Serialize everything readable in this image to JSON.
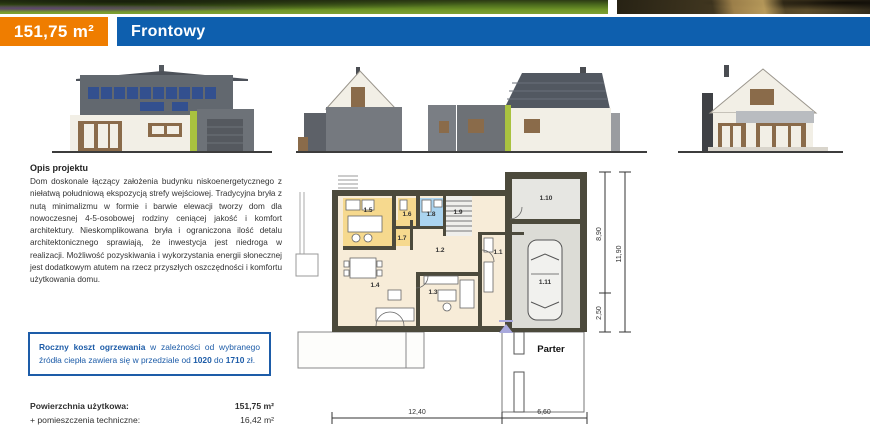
{
  "header": {
    "area": "151,75 m²",
    "project_name": "Frontowy"
  },
  "description": {
    "title": "Opis projektu",
    "body": "Dom doskonale łączący założenia budynku nisko­energetycznego z niełatwą południową ekspozycją strefy wejściowej. Tradycyjna bryła z nutą minimalizmu w formie i barwie elewacji tworzy dom dla nowoczesnej 4-5-osobowej rodziny ceniącej jakość i komfort architektury. Nieskomplikowana bryła i ograniczona ilość detalu architektonicznego sprawiają, że inwestycja jest niedroga w realizacji. Możliwość pozyskiwania i wykorzystania energii słonecznej jest dodatkowym atutem na rzecz przyszłych oszczędności i komfortu użytkowania domu."
  },
  "info_box": {
    "segments": [
      {
        "text": "Roczny koszt ogrzewania",
        "bold": true
      },
      {
        "text": " w zależności od wybranego źródła ciepła zawiera się w przedziale od ",
        "bold": false
      },
      {
        "text": "1020",
        "bold": true
      },
      {
        "text": " do ",
        "bold": false
      },
      {
        "text": "1710",
        "bold": true
      },
      {
        "text": " zł.",
        "bold": false
      }
    ]
  },
  "areas": {
    "rows": [
      {
        "label": "Powierzchnia użytkowa:",
        "value": "151,75 m²"
      },
      {
        "label": "+ pomieszczenia techniczne:",
        "value": "16,42 m²"
      }
    ]
  },
  "plan": {
    "floor_label": "Parter",
    "rooms": [
      {
        "id": "1.1"
      },
      {
        "id": "1.2"
      },
      {
        "id": "1.3"
      },
      {
        "id": "1.4"
      },
      {
        "id": "1.5"
      },
      {
        "id": "1.6"
      },
      {
        "id": "1.7"
      },
      {
        "id": "1.8"
      },
      {
        "id": "1.9"
      },
      {
        "id": "1.10"
      },
      {
        "id": "1.11"
      }
    ],
    "dimensions": {
      "bottom_main": "12,40",
      "bottom_garage": "6,60",
      "right_upper": "8,90",
      "right_lower": "2,50",
      "right_total": "11,90"
    }
  },
  "colors": {
    "accent_orange": "#ef7d00",
    "accent_blue": "#0e5fae",
    "infobox_blue": "#1d5ca8",
    "plan_wall": "#4c4a3c",
    "plan_floor": "#f7ecd8",
    "plan_kitchen_yellow": "#f6d98e",
    "plan_bath_blue": "#abd4f0"
  }
}
